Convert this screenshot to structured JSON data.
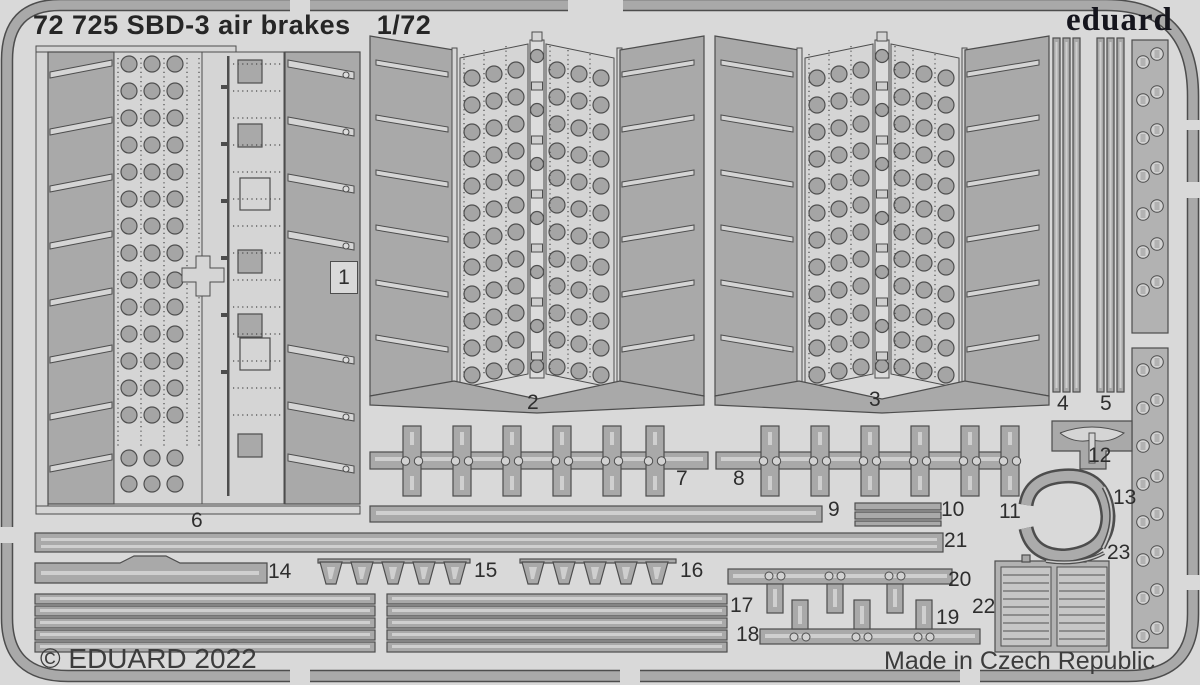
{
  "header": {
    "code": "72 725",
    "name": "SBD-3 air brakes",
    "scale": "1/72"
  },
  "brand": {
    "logo": "eduard"
  },
  "footer": {
    "copyright": "© EDUARD 2022",
    "made_in": "Made in Czech Republic"
  },
  "part_numbers": [
    "1",
    "2",
    "3",
    "4",
    "5",
    "6",
    "7",
    "8",
    "9",
    "10",
    "11",
    "12",
    "13",
    "14",
    "15",
    "16",
    "17",
    "18",
    "19",
    "20",
    "21",
    "22",
    "23"
  ],
  "sheet": {
    "type": "photo-etch fret illustration",
    "part_count": 23,
    "colors": {
      "background": "#d9d9d9",
      "fret_metal": "#a9a9a9",
      "panel_light": "#d5d5d5",
      "outline": "#4d4d4d",
      "text": "#2e2e2e",
      "logo": "#15151d"
    }
  }
}
